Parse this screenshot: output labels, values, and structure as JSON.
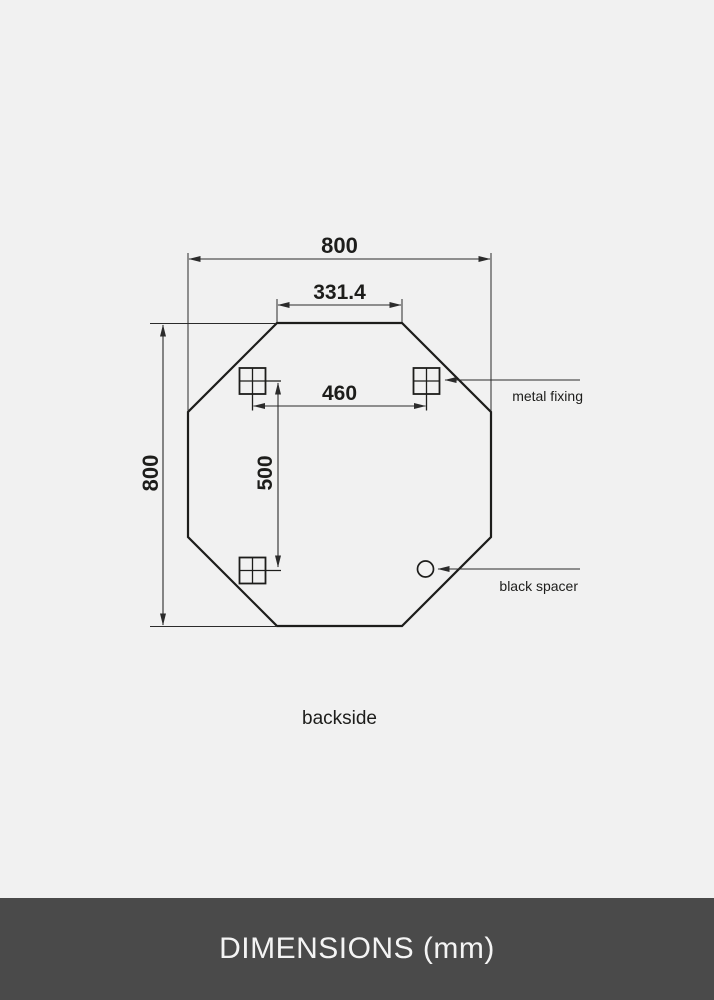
{
  "diagram": {
    "view_label": "backside",
    "shape": "octagonal mirror backside",
    "unit": "mm",
    "dimensions": {
      "overall_width": "800",
      "overall_height": "800",
      "top_edge_width": "331.4",
      "fixing_span_horizontal": "460",
      "fixing_span_vertical": "500"
    },
    "callouts": {
      "metal_fixing": "metal fixing",
      "black_spacer": "black spacer"
    },
    "colors": {
      "background": "#f1f1f1",
      "line": "#1d1d1b",
      "footer_background": "#4a4a4a",
      "footer_text": "#f4f4f4"
    }
  },
  "footer": {
    "title": "DIMENSIONS (mm)"
  }
}
